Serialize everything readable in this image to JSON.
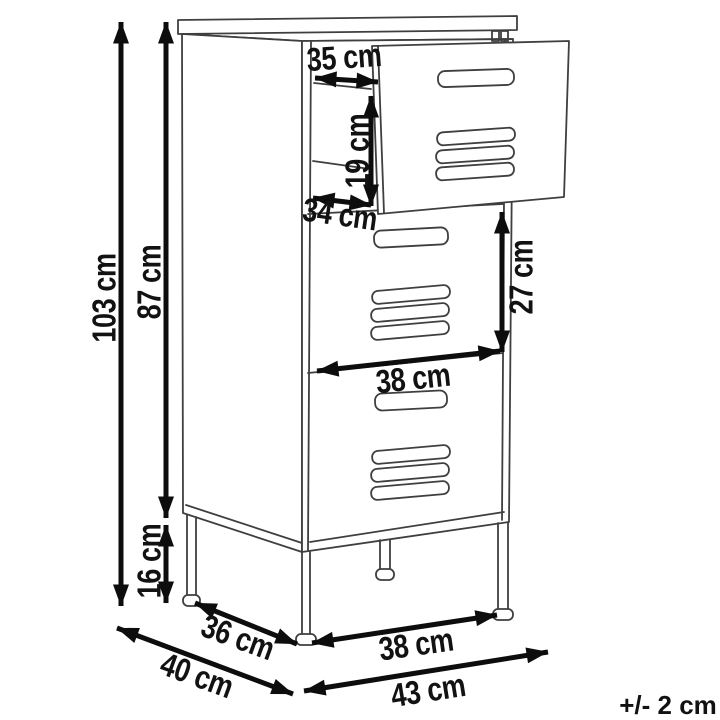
{
  "diagram": {
    "tolerance_note": "+/- 2 cm",
    "dimensions": {
      "total_height": "103 cm",
      "body_height": "87 cm",
      "leg_height": "16 cm",
      "opening_width": "35 cm",
      "opening_height": "19 cm",
      "opening_depth": "34 cm",
      "door_height": "27 cm",
      "door_width": "38 cm",
      "base_depth": "36 cm",
      "total_depth": "40 cm",
      "base_width": "38 cm",
      "total_width": "43 cm"
    }
  }
}
